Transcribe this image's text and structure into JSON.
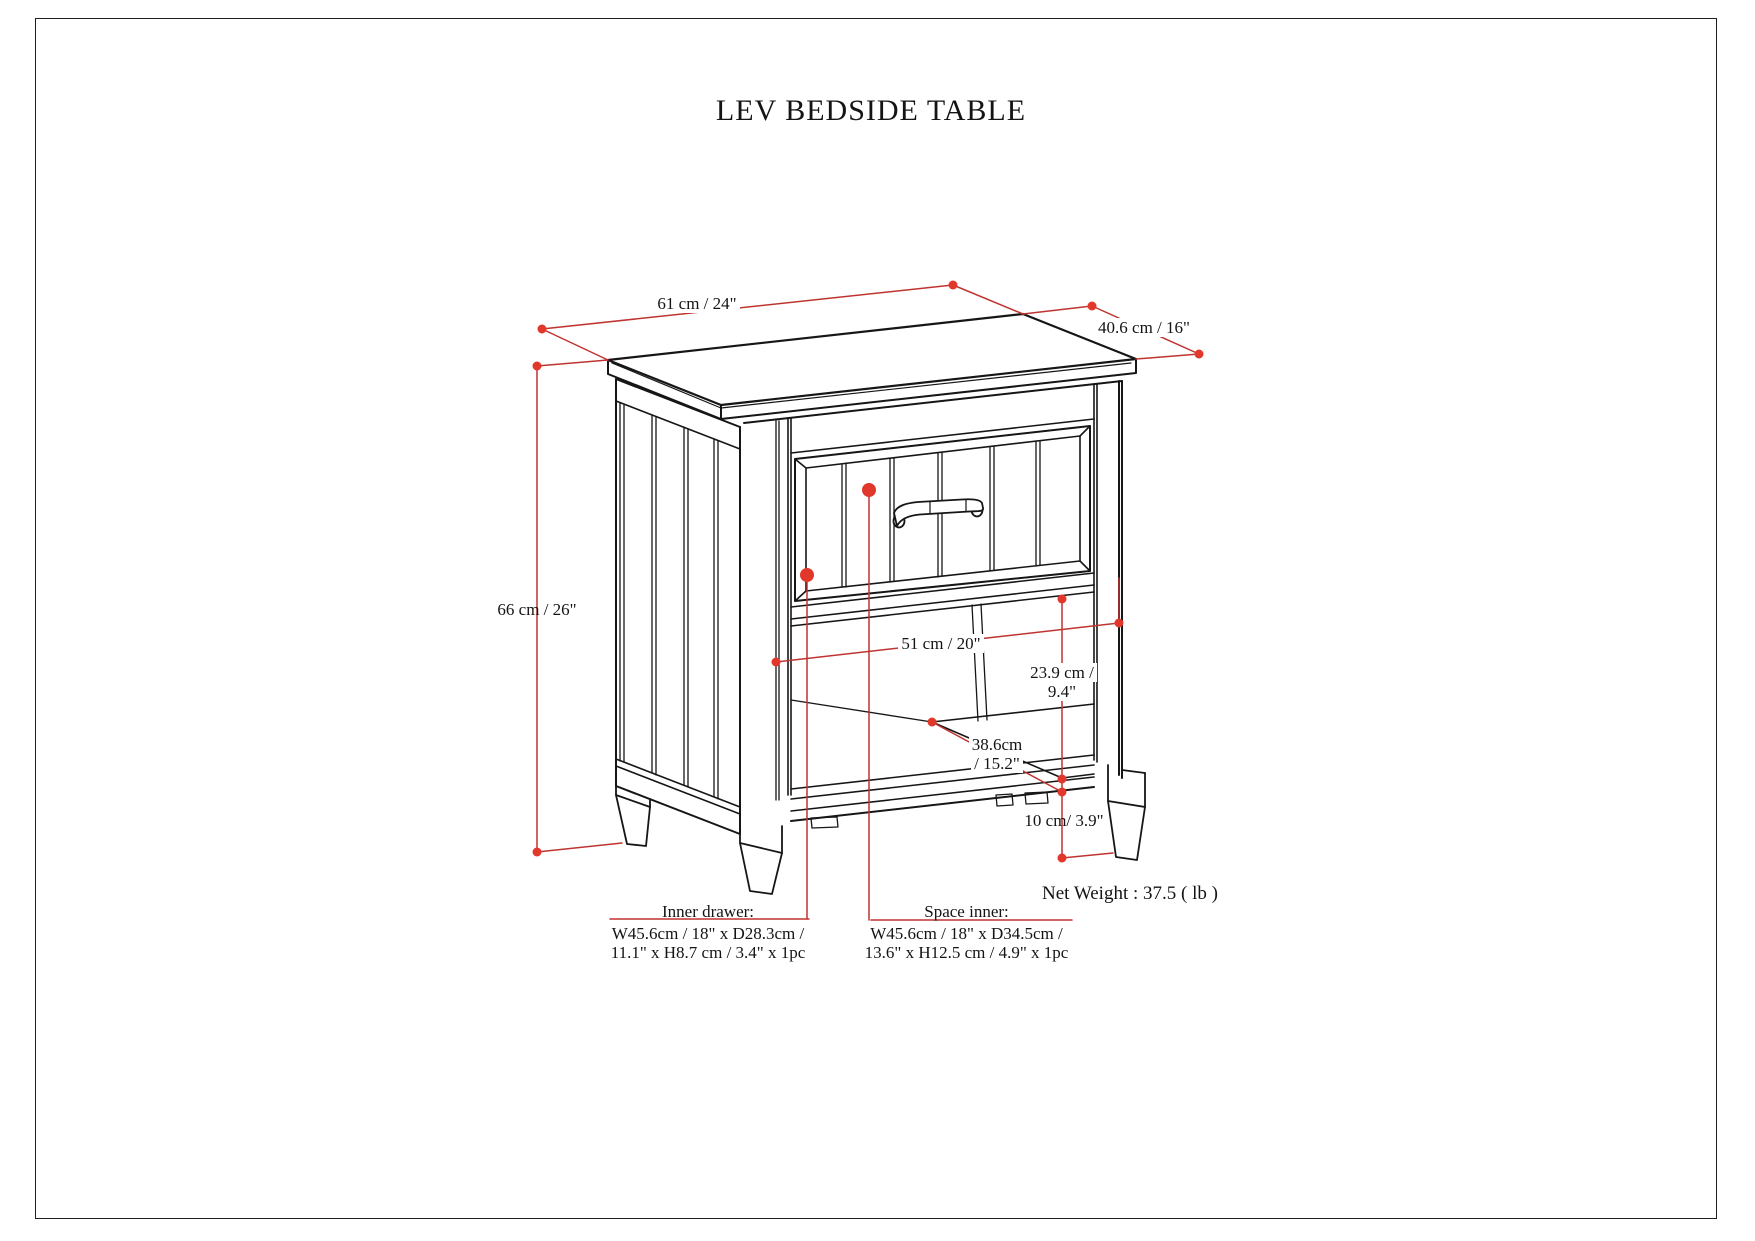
{
  "title": "LEV BEDSIDE TABLE",
  "dimensions": {
    "width": "61 cm / 24\"",
    "depth": "40.6 cm / 16\"",
    "height": "66 cm / 26\"",
    "opening_width": "51 cm / 20\"",
    "opening_height": [
      "23.9 cm /",
      "9.4\""
    ],
    "shelf_depth": [
      "38.6cm",
      "/ 15.2\""
    ],
    "leg_clearance": "10 cm/ 3.9\""
  },
  "net_weight": "Net Weight : 37.5 ( lb )",
  "callouts": {
    "inner_drawer": {
      "heading": "Inner drawer:",
      "line1": "W45.6cm / 18\" x D28.3cm /",
      "line2": "11.1\" x H8.7 cm / 3.4\" x 1pc"
    },
    "space_inner": {
      "heading": "Space inner:",
      "line1": "W45.6cm / 18\" x D34.5cm /",
      "line2": "13.6\" x H12.5 cm / 4.9\" x 1pc"
    }
  },
  "colors": {
    "dimension_line_red": "#bf3430",
    "marker_dot_red": "#e2382c",
    "drawing_black": "#161616",
    "background": "#ffffff"
  }
}
